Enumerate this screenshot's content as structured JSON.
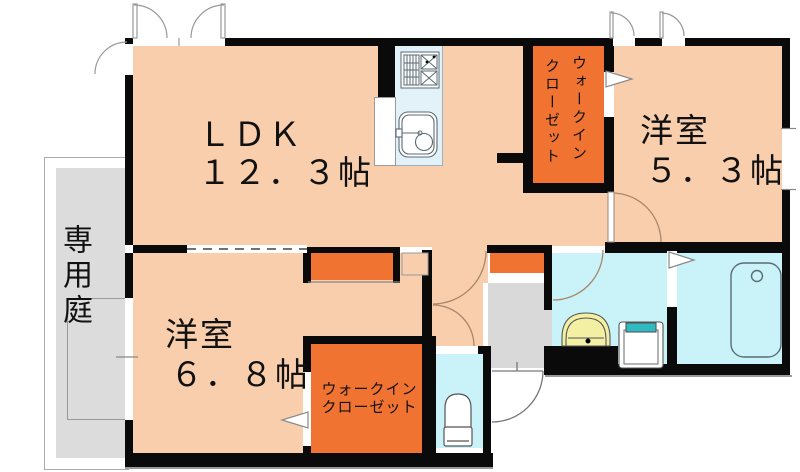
{
  "plan_title": "apartment-floor-plan",
  "rooms": {
    "ldk": {
      "name": "ＬＤＫ",
      "size": "１２．３帖"
    },
    "western_room_1": {
      "name": "洋室",
      "size": "５．３帖"
    },
    "western_room_2": {
      "name": "洋室",
      "size": "６．８帖"
    },
    "walk_in_closet_1": {
      "line1": "ウォークイン",
      "line2": "クローゼット"
    },
    "walk_in_closet_2": {
      "line1": "ウォークイン",
      "line2": "クローゼット"
    },
    "private_garden": {
      "name": "専用庭"
    }
  },
  "fixtures": {
    "kitchen_stove": "stove-icon",
    "kitchen_sink": "sink-icon",
    "toilet": "toilet-icon",
    "bathtub": "bathtub-icon",
    "washbasin": "washbasin-icon",
    "washing_machine_pan": "washing-machine-pan-icon"
  },
  "colors": {
    "wall": "#0a0a0a",
    "room_floor": "#F8CEAD",
    "closet_orange": "#F07332",
    "wet_area_cyan": "#C9F3F8",
    "entrance_gray": "#D9D9D9",
    "garden_gray": "#DCDCDC",
    "washbasin_yellow": "#F3F0A4",
    "washer_teal": "#2FB9C0"
  }
}
